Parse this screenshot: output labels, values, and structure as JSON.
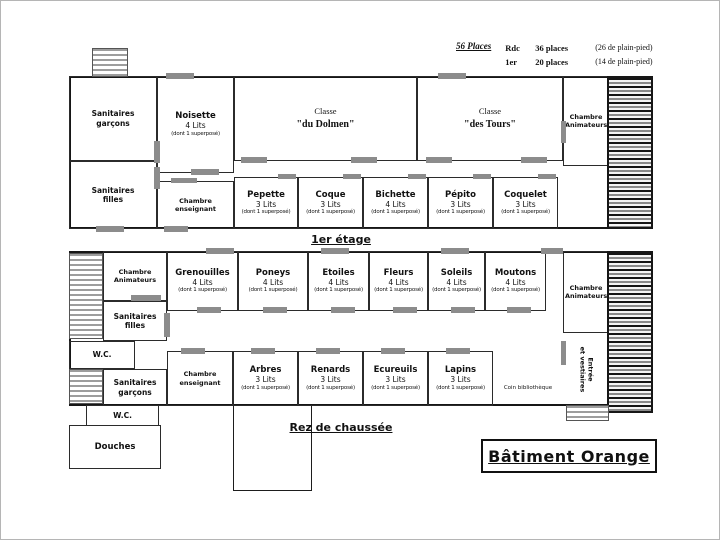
{
  "header": {
    "total": "56 Places",
    "rdc_floor": "Rdc",
    "rdc_places": "36 places",
    "rdc_note": "(26 de plain-pied)",
    "e1_floor": "1er",
    "e1_places": "20 places",
    "e1_note": "(14 de plain-pied)"
  },
  "floor1": {
    "label": "1er étage",
    "sanitaires_garcons": "Sanitaires garçons",
    "sanitaires_filles": "Sanitaires filles",
    "noisette": {
      "name": "Noisette",
      "beds": "4 Lits",
      "note": "(dont 1 superposé)"
    },
    "chambre_enseignant": "Chambre enseignant",
    "classe1_line1": "Classe",
    "classe1_line2": "\"du Dolmen\"",
    "classe2_line1": "Classe",
    "classe2_line2": "\"des Tours\"",
    "chambre_animateurs": "Chambre Animateurs",
    "rooms": [
      {
        "name": "Pepette",
        "beds": "3 Lits",
        "note": "(dont 1 superposé)"
      },
      {
        "name": "Coque",
        "beds": "3 Lits",
        "note": "(dont 1 superposé)"
      },
      {
        "name": "Bichette",
        "beds": "4 Lits",
        "note": "(dont 1 superposé)"
      },
      {
        "name": "Pépito",
        "beds": "3 Lits",
        "note": "(dont 1 superposé)"
      },
      {
        "name": "Coquelet",
        "beds": "3 Lits",
        "note": "(dont 1 superposé)"
      }
    ]
  },
  "floor0": {
    "label": "Rez de chaussée",
    "chambre_animateurs_left": "Chambre Animateurs",
    "chambre_animateurs_right": "Chambre Animateurs",
    "sanitaires_filles": "Sanitaires filles",
    "sanitaires_garcons": "Sanitaires garçons",
    "chambre_enseignant": "Chambre enseignant",
    "wc_left": "W.C.",
    "wc_annex": "W.C.",
    "douches": "Douches",
    "coin_bibliotheque": "Coin bibliothèque",
    "entree_line1": "Entrée",
    "entree_line2": "et vestiaires",
    "top_rooms": [
      {
        "name": "Grenouilles",
        "beds": "4 Lits",
        "note": "(dont 1 superposé)"
      },
      {
        "name": "Poneys",
        "beds": "4 Lits",
        "note": "(dont 1 superposé)"
      },
      {
        "name": "Etoiles",
        "beds": "4 Lits",
        "note": "(dont 1 superposé)"
      },
      {
        "name": "Fleurs",
        "beds": "4 Lits",
        "note": "(dont 1 superposé)"
      },
      {
        "name": "Soleils",
        "beds": "4 Lits",
        "note": "(dont 1 superposé)"
      },
      {
        "name": "Moutons",
        "beds": "4 Lits",
        "note": "(dont 1 superposé)"
      }
    ],
    "bottom_rooms": [
      {
        "name": "Arbres",
        "beds": "3 Lits",
        "note": "(dont 1 superposé)"
      },
      {
        "name": "Renards",
        "beds": "3 Lits",
        "note": "(dont 1 superposé)"
      },
      {
        "name": "Ecureuils",
        "beds": "3 Lits",
        "note": "(dont 1 superposé)"
      },
      {
        "name": "Lapins",
        "beds": "3 Lits",
        "note": "(dont 1 superposé)"
      }
    ]
  },
  "building_label": "Bâtiment Orange",
  "colors": {
    "wall": "#1d1d1d",
    "door": "#8c8c8c",
    "accent": "#111111"
  }
}
